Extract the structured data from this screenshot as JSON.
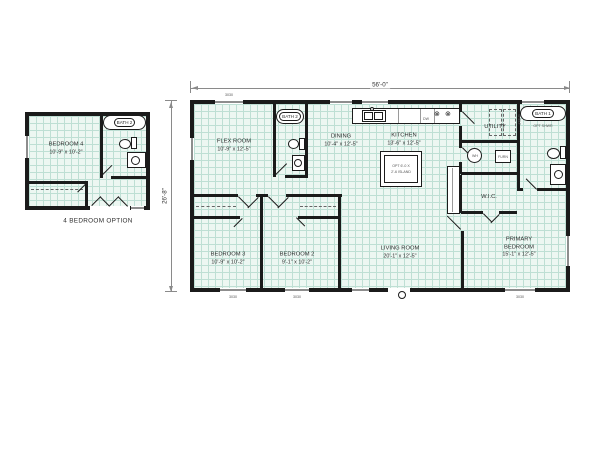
{
  "colors": {
    "wall": "#1b1b1b",
    "floor-fill": "#edf7f2",
    "floor-grid": "#bedfd4",
    "dim": "#8a8a8a",
    "text": "#2e2e2e"
  },
  "icons": {
    "burner": "⊗"
  },
  "main_plan": {
    "width_dim": "56'-0\"",
    "depth_dim": "26'-8\"",
    "rooms": {
      "flex": {
        "name": "FLEX ROOM",
        "dims": "10'-9\" x 12'-5\""
      },
      "bath2": {
        "name": "BATH 2"
      },
      "dining": {
        "name": "DINING",
        "dims": "10'-4\" x 12'-5\""
      },
      "kitchen": {
        "name": "KITCHEN",
        "dims": "13'-6\" x 12'-5\""
      },
      "utility": {
        "name": "UTILITY"
      },
      "bath1": {
        "name": "BATH 1"
      },
      "wic": {
        "name": "W.I.C."
      },
      "bedroom3": {
        "name": "BEDROOM 3",
        "dims": "10'-9\" x 10'-2\""
      },
      "bedroom2": {
        "name": "BEDROOM 2",
        "dims": "9'-1\" x 10'-2\""
      },
      "living": {
        "name": "LIVING ROOM",
        "dims": "20'-1\" x 12'-5\""
      },
      "primary": {
        "name": "PRIMARY BEDROOM",
        "dims": "15'-1\" x 12'-5\""
      }
    },
    "fixture_labels": {
      "water_heater": "WH",
      "furnace": "FURN",
      "dishwasher": "DW",
      "island_line1": "OPT 6'-0 X",
      "island_line2": "2'-6 ISLAND",
      "opt_shower": "OPT SHWR",
      "shelf": "SHELF",
      "window_size": "3030"
    }
  },
  "option_plan": {
    "caption": "4 BEDROOM OPTION",
    "rooms": {
      "bedroom4": {
        "name": "BEDROOM 4",
        "dims": "10'-9\" x 10'-2\""
      },
      "bath2": {
        "name": "BATH 2"
      }
    }
  }
}
